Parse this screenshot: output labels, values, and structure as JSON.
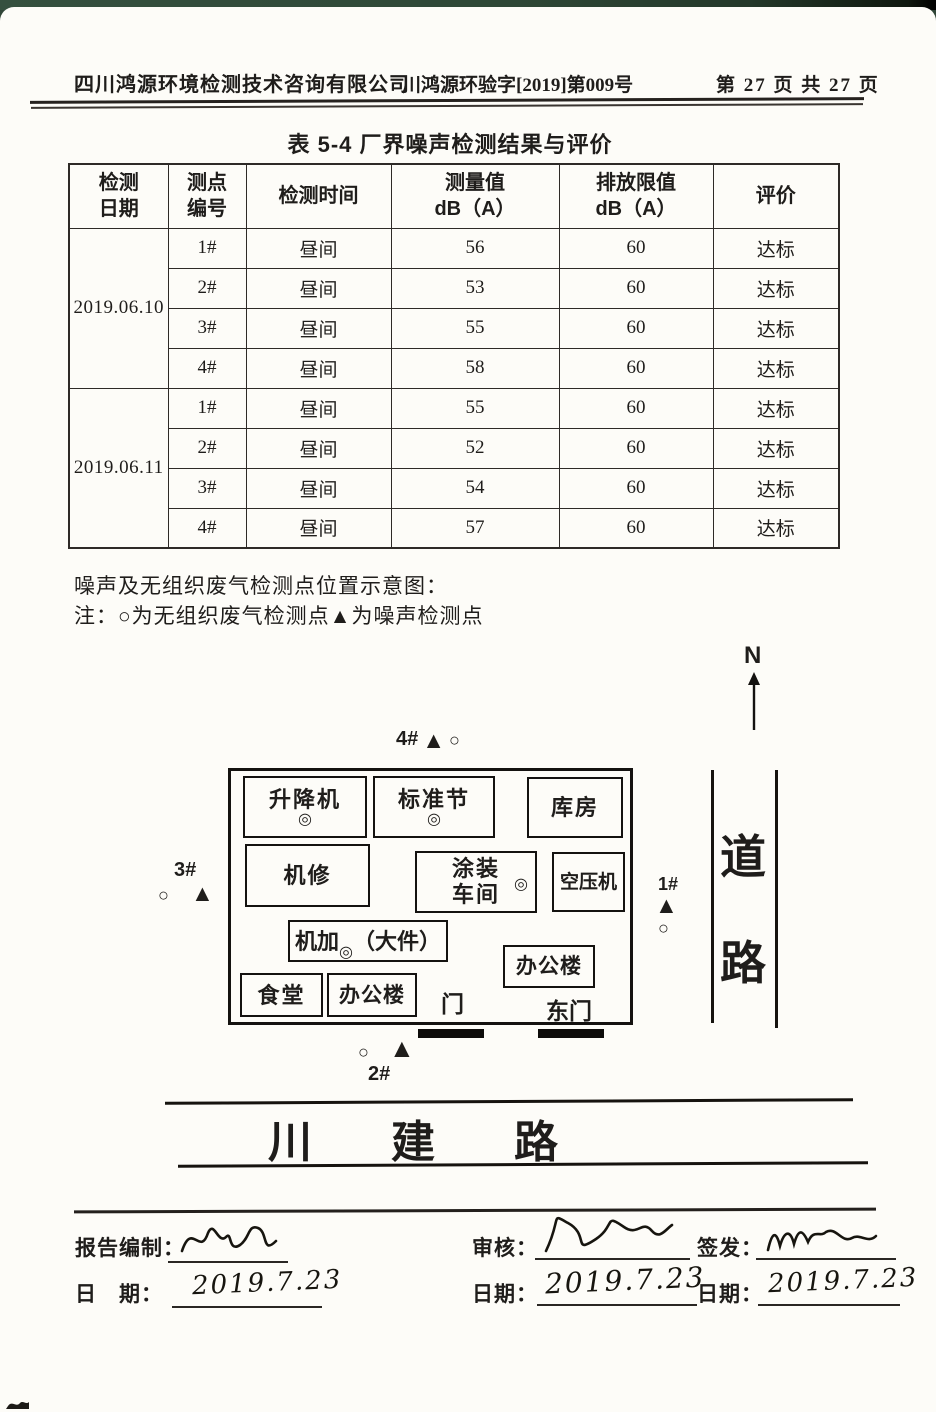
{
  "header": {
    "company": "四川鸿源环境检测技术咨询有限公司",
    "doc_number": "川鸿源环验字[2019]第009号",
    "page_info": "第 27 页 共 27 页"
  },
  "table": {
    "title": "表 5-4  厂界噪声检测结果与评价",
    "columns": [
      {
        "line1": "检测",
        "line2": "日期"
      },
      {
        "line1": "测点",
        "line2": "编号"
      },
      {
        "line1": "检测时间",
        "line2": ""
      },
      {
        "line1": "测量值",
        "line2": "dB（A）"
      },
      {
        "line1": "排放限值",
        "line2": "dB（A）"
      },
      {
        "line1": "评价",
        "line2": ""
      }
    ],
    "groups": [
      {
        "date": "2019.06.10",
        "rows": [
          [
            "1#",
            "昼间",
            "56",
            "60",
            "达标"
          ],
          [
            "2#",
            "昼间",
            "53",
            "60",
            "达标"
          ],
          [
            "3#",
            "昼间",
            "55",
            "60",
            "达标"
          ],
          [
            "4#",
            "昼间",
            "58",
            "60",
            "达标"
          ]
        ]
      },
      {
        "date": "2019.06.11",
        "rows": [
          [
            "1#",
            "昼间",
            "55",
            "60",
            "达标"
          ],
          [
            "2#",
            "昼间",
            "52",
            "60",
            "达标"
          ],
          [
            "3#",
            "昼间",
            "54",
            "60",
            "达标"
          ],
          [
            "4#",
            "昼间",
            "57",
            "60",
            "达标"
          ]
        ]
      }
    ]
  },
  "diagram": {
    "caption": "噪声及无组织废气检测点位置示意图：",
    "legend_note": "注：○为无组织废气检测点▲为噪声检测点",
    "compass_label": "N",
    "symbols": {
      "noise": "▲",
      "gas": "○",
      "building_point": "◎"
    },
    "markers": {
      "p1": "1#",
      "p2": "2#",
      "p3": "3#",
      "p4": "4#"
    },
    "buildings": {
      "hoist": "升降机",
      "standard_section": "标准节",
      "warehouse": "库房",
      "machine_repair": "机修",
      "coating_line1": "涂装",
      "coating_line2": "车间",
      "air_compressor": "空压机",
      "machining_prefix": "机加",
      "machining_suffix": "（大件）",
      "office_east": "办公楼",
      "canteen": "食堂",
      "office_south": "办公楼",
      "gate": "门",
      "east_gate": "东门"
    },
    "roads": {
      "east_road_char1": "道",
      "east_road_char2": "路",
      "south_road": "川 建 路"
    }
  },
  "signoff": {
    "prepared_label": "报告编制：",
    "prepared_date_label": "日　期：",
    "prepared_date": "2019.7.23",
    "review_label": "审核：",
    "review_date_label": "日期：",
    "review_date": "2019.7.23",
    "issue_label": "签发：",
    "issue_date_label": "日期：",
    "issue_date": "2019.7.23"
  }
}
